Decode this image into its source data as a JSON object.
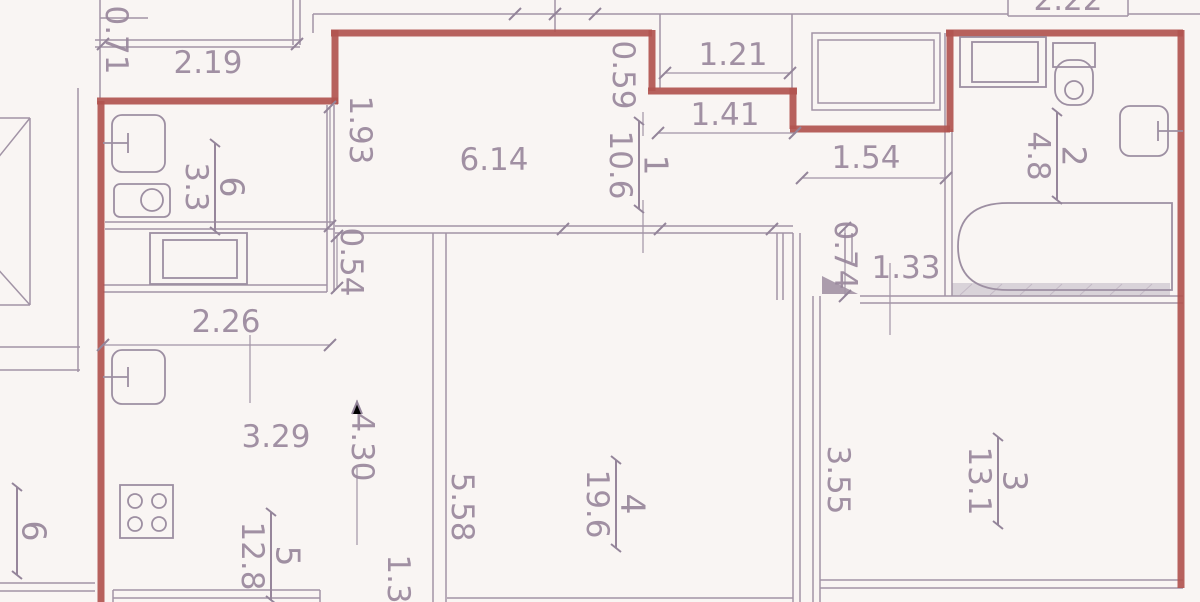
{
  "document": {
    "kind": "apartment floor plan",
    "units": "meters"
  },
  "colors": {
    "boundary_wall": "#b25551",
    "line": "#a294a6",
    "text": "#97869b",
    "background": "#f9f5f3",
    "shaded_band": "#d9d3d9"
  },
  "rooms": [
    {
      "number": "1",
      "area": "10.6",
      "x": 640,
      "y": 165
    },
    {
      "number": "2",
      "area": "4.8",
      "x": 1058,
      "y": 156
    },
    {
      "number": "3",
      "area": "13.1",
      "x": 999,
      "y": 481
    },
    {
      "number": "4",
      "area": "19.6",
      "x": 617,
      "y": 504
    },
    {
      "number": "5",
      "area": "12.8",
      "x": 272,
      "y": 556
    },
    {
      "number": "6",
      "area": "3.3",
      "x": 216,
      "y": 187
    },
    {
      "number": "6",
      "area": "",
      "x": 18,
      "y": 531
    }
  ],
  "dimensions": [
    {
      "value": "0.71",
      "x": 116,
      "y": 40,
      "vertical": true
    },
    {
      "value": "2.19",
      "x": 208,
      "y": 63,
      "vertical": false
    },
    {
      "value": "1.93",
      "x": 360,
      "y": 130,
      "vertical": true
    },
    {
      "value": "6.14",
      "x": 494,
      "y": 160,
      "vertical": false
    },
    {
      "value": "0.59",
      "x": 623,
      "y": 75,
      "vertical": true
    },
    {
      "value": "1.21",
      "x": 733,
      "y": 55,
      "vertical": false
    },
    {
      "value": "1.41",
      "x": 725,
      "y": 115,
      "vertical": false
    },
    {
      "value": "2.22",
      "x": 1068,
      "y": 0,
      "vertical": false
    },
    {
      "value": "1.54",
      "x": 866,
      "y": 158,
      "vertical": false
    },
    {
      "value": "0.54",
      "x": 351,
      "y": 262,
      "vertical": true
    },
    {
      "value": "0.74",
      "x": 845,
      "y": 255,
      "vertical": true
    },
    {
      "value": "1.33",
      "x": 906,
      "y": 268,
      "vertical": false
    },
    {
      "value": "2.26",
      "x": 226,
      "y": 322,
      "vertical": false
    },
    {
      "value": "3.29",
      "x": 276,
      "y": 437,
      "vertical": false
    },
    {
      "value": "4.30",
      "x": 362,
      "y": 447,
      "vertical": true
    },
    {
      "value": "5.58",
      "x": 462,
      "y": 507,
      "vertical": true
    },
    {
      "value": "3.55",
      "x": 838,
      "y": 480,
      "vertical": true
    },
    {
      "value": "1.3",
      "x": 398,
      "y": 579,
      "vertical": true
    }
  ]
}
